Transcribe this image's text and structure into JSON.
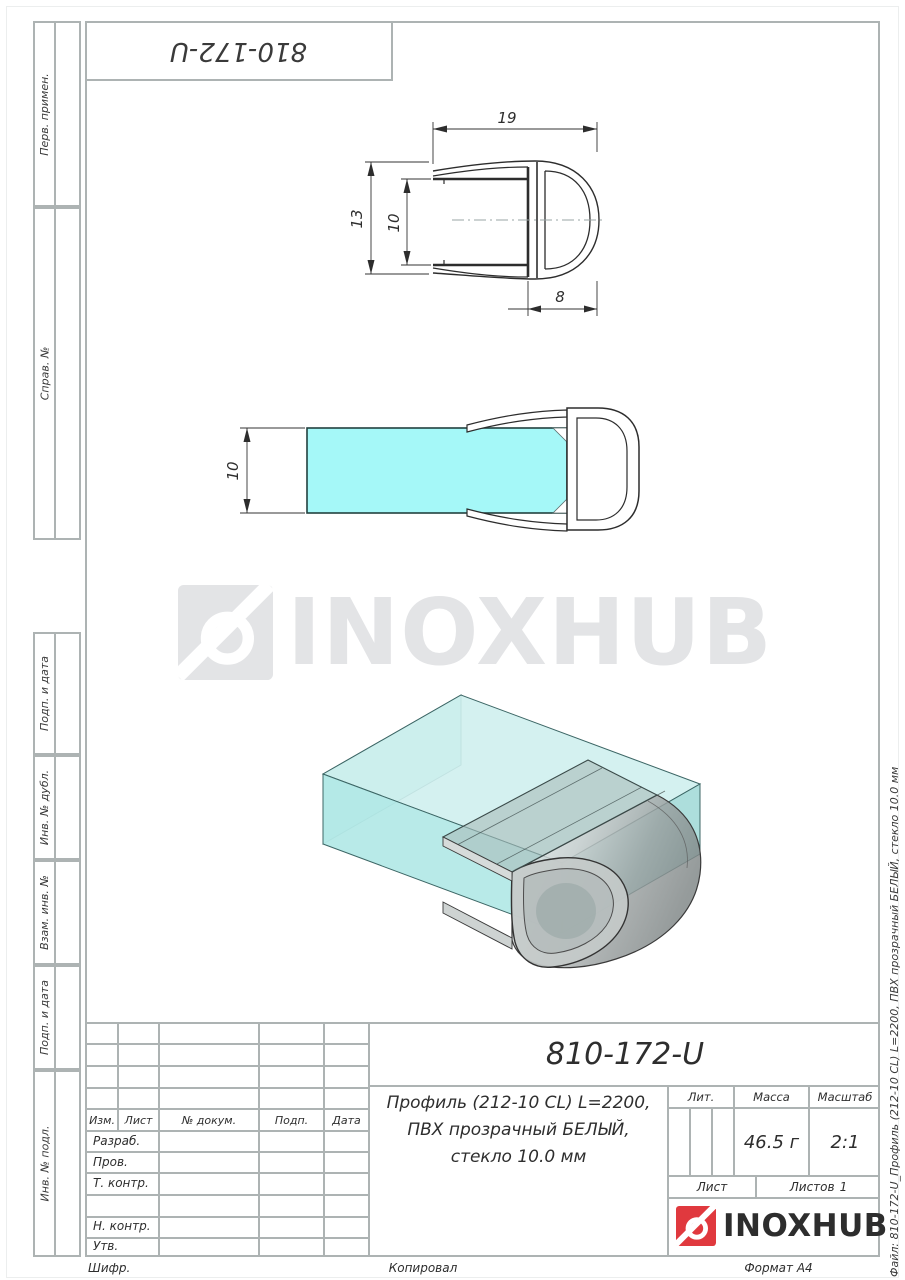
{
  "corner_stamp": {
    "doc_number": "810-172-U"
  },
  "left_margin": {
    "labels": [
      "Перв. примен.",
      "Справ. №",
      "Подп. и дата",
      "Инв. № дубл.",
      "Взам. инв. №",
      "Подп. и дата",
      "Инв. № подл."
    ]
  },
  "right_margin": {
    "file_note": "Файл: 810-172-U_Профиль (212-10 CL) L=2200, ПВХ прозрачный БЕЛЫЙ, стекло 10.0 мм"
  },
  "watermark": {
    "brand": "INOXHUB"
  },
  "drawing": {
    "cross_section": {
      "dim_width": "19",
      "dim_height": "13",
      "dim_inner": "10",
      "dim_bulb": "8"
    },
    "side_view": {
      "dim_glass": "10"
    }
  },
  "title_block": {
    "doc_number": "810-172-U",
    "description_line1": "Профиль (212-10 CL) L=2200,",
    "description_line2": "ПВХ прозрачный БЕЛЫЙ,",
    "description_line3": "стекло 10.0 мм",
    "lit_label": "Лит.",
    "mass_label": "Масса",
    "scale_label": "Масштаб",
    "mass_value": "46.5 г",
    "scale_value": "2:1",
    "sheet_label": "Лист",
    "sheets_label": "Листов",
    "sheets_value": "1",
    "rev_columns": [
      "Изм.",
      "Лист",
      "№ докум.",
      "Подп.",
      "Дата"
    ],
    "roles": [
      "Разраб.",
      "Пров.",
      "Т. контр.",
      "",
      "Н. контр.",
      "Утв."
    ],
    "brand": "INOXHUB"
  },
  "footer": {
    "cipher_label": "Шифр.",
    "copied_label": "Копировал",
    "format_label": "Формат А4"
  },
  "colors": {
    "accent_red": "#e0393e",
    "glass_cyan": "#a5f8f8",
    "watermark_gray": "#e3e4e6",
    "line_gray": "#adb3b3",
    "ink": "#2d2d2d"
  }
}
